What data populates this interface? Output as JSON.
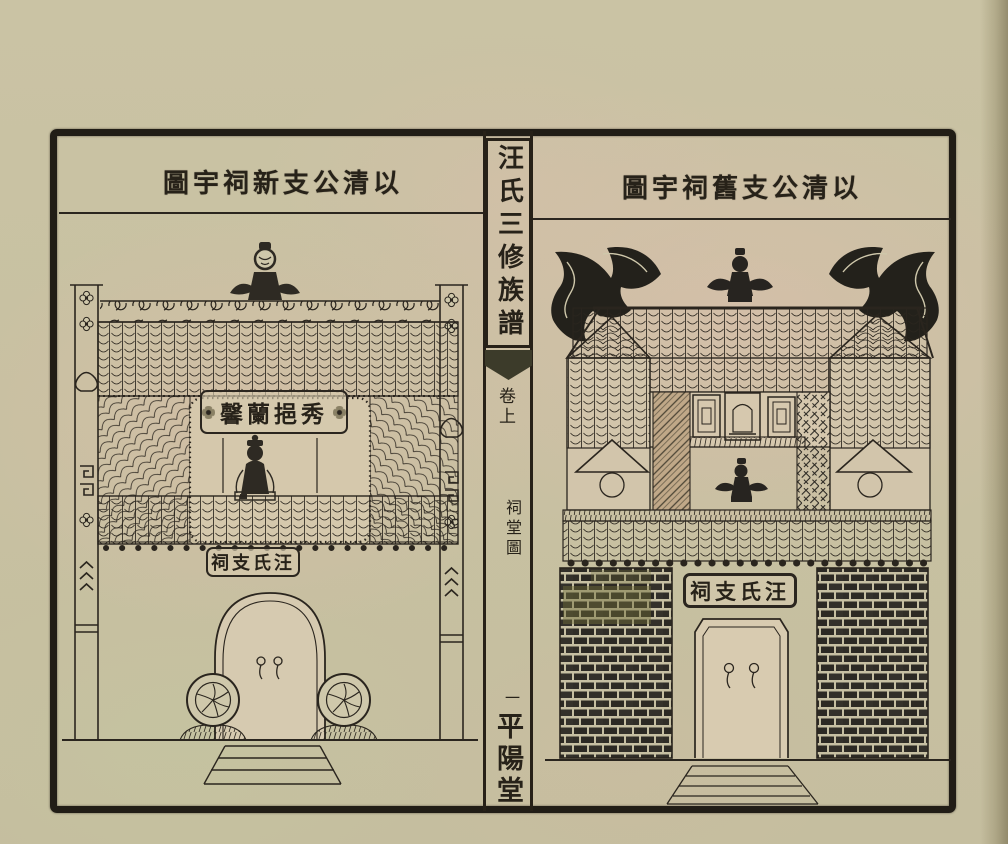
{
  "book": {
    "spine": {
      "title": "汪氏三修族譜",
      "volume_label": "卷上",
      "section_label": "祠堂圖",
      "page_number": "一",
      "hall_mark": "平陽堂"
    },
    "left_page": {
      "caption_display": "圖宇祠新支公清以",
      "caption_reading": "以清公支新祠宇圖",
      "hall_plaque_display": "馨蘭挹秀",
      "hall_plaque_reading": "秀挹蘭馨",
      "gate_plaque_display": "祠支氏汪",
      "gate_plaque_reading": "汪氏支祠"
    },
    "right_page": {
      "caption_display": "圖宇祠舊支公清以",
      "caption_reading": "以清公支舊祠宇圖",
      "gate_plaque_display": "祠支氏汪",
      "gate_plaque_reading": "汪氏支祠"
    }
  },
  "colors": {
    "paper_olive": "#cbc4a5",
    "paper_pink": "#d7c4b0",
    "ink": "#272219",
    "frame": "#211d16",
    "brick_dark": "#2c2923",
    "brick_olive": "#6e6c38"
  }
}
